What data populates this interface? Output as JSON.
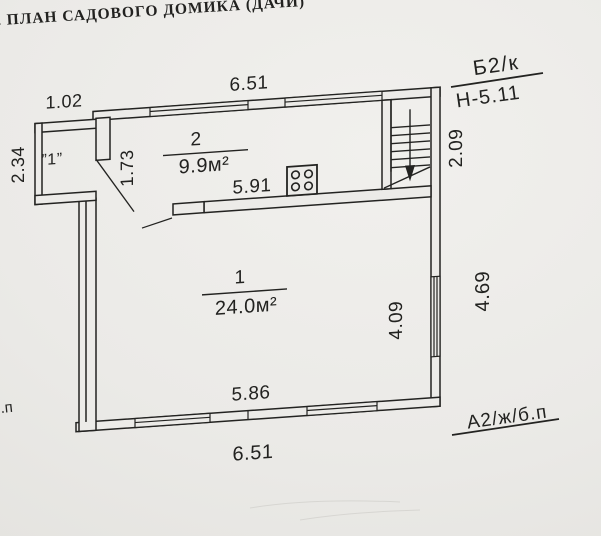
{
  "page": {
    "title": "В. ПЛАН САДОВОГО ДОМИКА (ДАЧИ)"
  },
  "plan": {
    "rooms": [
      {
        "number": "2",
        "area": "9.9м²"
      },
      {
        "number": "1",
        "area": "24.0м²"
      }
    ],
    "porch_label": "”1”",
    "dims": {
      "top_width": "6.51",
      "porch_width": "1.02",
      "porch_depth": "2.34",
      "hall_width": "1.73",
      "kitchen_width": "5.91",
      "stair_depth": "2.09",
      "room_depth": "4.09",
      "right_side": "4.69",
      "room_width": "5.86",
      "bottom_width": "6.51"
    }
  },
  "annotations": {
    "building_mark_top": "Б2/к",
    "height_mark": "Н-5.11",
    "building_mark_bottom": "А2/ж/б.п",
    "edge_fragment": ".п"
  },
  "colors": {
    "paper": "#ecebe8",
    "ink": "#232321"
  }
}
